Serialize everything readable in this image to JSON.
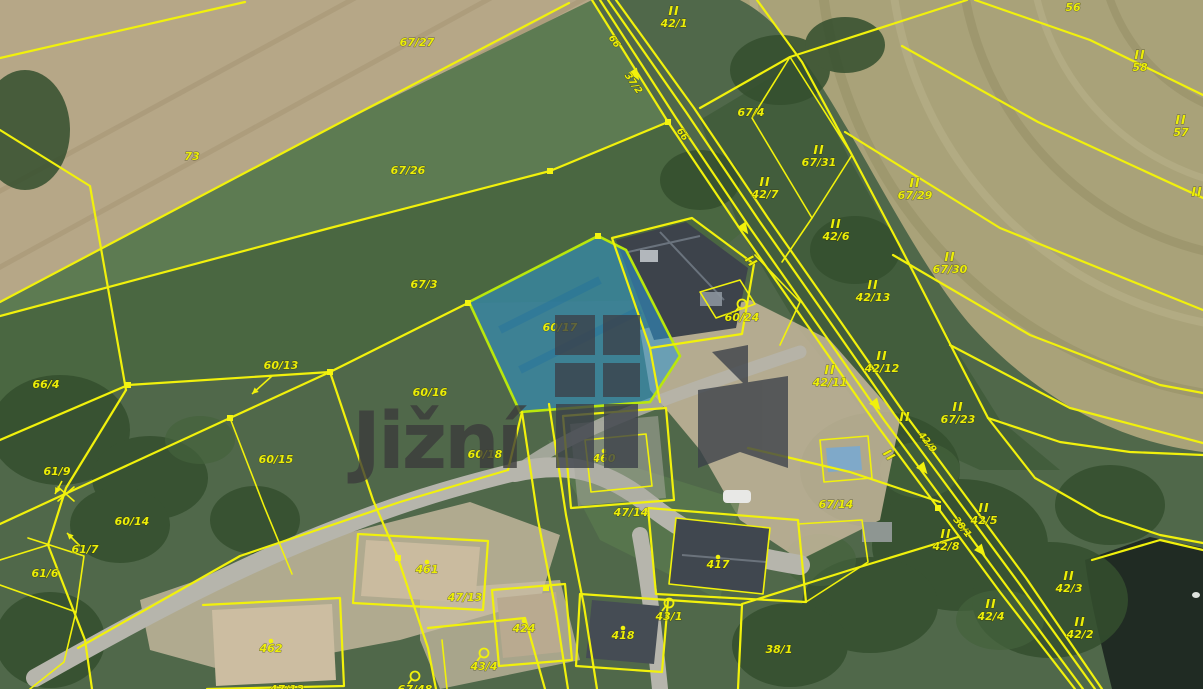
{
  "map": {
    "kind": "cadastral-parcel-map-over-orthophoto",
    "watermark": {
      "text": "Jižní",
      "color": "#3b3b3b"
    },
    "highlighted_parcel": {
      "number": "60/17",
      "fill": "#2e96d2",
      "outline": "#b9e70c"
    },
    "colors": {
      "parcel_line": "#f1f10c",
      "label_text": "#ecee08",
      "grass_green": "#50684a",
      "field_tan": "#b6a787",
      "field_olive": "#a9a279",
      "road_gray": "#b6b5ac",
      "water_dark": "#202b23"
    },
    "labels": [
      {
        "text": "67/27",
        "x": 417,
        "y": 46
      },
      {
        "text": "73",
        "x": 192,
        "y": 160
      },
      {
        "text": "67/26",
        "x": 408,
        "y": 174
      },
      {
        "text": "67/3",
        "x": 424,
        "y": 288
      },
      {
        "text": "66/4",
        "x": 46,
        "y": 388
      },
      {
        "text": "42/1",
        "x": 674,
        "y": 27,
        "marker": "ii"
      },
      {
        "text": "67/4",
        "x": 751,
        "y": 116
      },
      {
        "text": "56",
        "x": 1073,
        "y": 11
      },
      {
        "text": "58",
        "x": 1140,
        "y": 71,
        "marker": "ii"
      },
      {
        "text": "57",
        "x": 1181,
        "y": 136,
        "marker": "ii"
      },
      {
        "text": "67/31",
        "x": 819,
        "y": 166,
        "marker": "ii"
      },
      {
        "text": "42/7",
        "x": 765,
        "y": 198,
        "marker": "ii"
      },
      {
        "text": "67/29",
        "x": 915,
        "y": 199,
        "marker": "ii"
      },
      {
        "text": "42/6",
        "x": 836,
        "y": 240,
        "marker": "ii"
      },
      {
        "text": "67/30",
        "x": 950,
        "y": 273,
        "marker": "ii"
      },
      {
        "text": "42/13",
        "x": 873,
        "y": 301,
        "marker": "ii"
      },
      {
        "text": "42/12",
        "x": 882,
        "y": 372,
        "marker": "ii"
      },
      {
        "text": "42/11",
        "x": 830,
        "y": 386,
        "marker": "ii"
      },
      {
        "text": "67/23",
        "x": 958,
        "y": 423,
        "marker": "ii"
      },
      {
        "text": "",
        "x": 905,
        "y": 421,
        "marker": "ii_only"
      },
      {
        "text": "",
        "x": 886,
        "y": 458,
        "marker": "ii_only",
        "rot": 50
      },
      {
        "text": "",
        "x": 748,
        "y": 264,
        "marker": "ii_only",
        "rot": 50
      },
      {
        "text": "",
        "x": 1197,
        "y": 196,
        "marker": "ii_only"
      },
      {
        "text": "42/9",
        "x": 925,
        "y": 444,
        "rot": 52,
        "small": true
      },
      {
        "text": "38/1",
        "x": 960,
        "y": 529,
        "rot": 52,
        "small": true
      },
      {
        "text": "37/2",
        "x": 631,
        "y": 85,
        "rot": 55,
        "small": true
      },
      {
        "text": "66",
        "x": 612,
        "y": 43,
        "rot": 55,
        "small": true
      },
      {
        "text": "66",
        "x": 680,
        "y": 136,
        "rot": 55,
        "small": true
      },
      {
        "text": "60/13",
        "x": 281,
        "y": 369,
        "arrow": {
          "x1": 272,
          "y1": 376,
          "x2": 252,
          "y2": 394
        }
      },
      {
        "text": "61/9",
        "x": 57,
        "y": 475,
        "arrow": {
          "x1": 62,
          "y1": 481,
          "x2": 55,
          "y2": 494
        }
      },
      {
        "text": "60/16",
        "x": 430,
        "y": 396
      },
      {
        "text": "60/15",
        "x": 276,
        "y": 463
      },
      {
        "text": "60/17",
        "x": 560,
        "y": 331
      },
      {
        "text": "60/18",
        "x": 485,
        "y": 458
      },
      {
        "text": "60/24",
        "x": 742,
        "y": 321,
        "marker": "mag"
      },
      {
        "text": "60/14",
        "x": 132,
        "y": 525
      },
      {
        "text": "61/7",
        "x": 85,
        "y": 553,
        "arrow": {
          "x1": 80,
          "y1": 546,
          "x2": 67,
          "y2": 533
        }
      },
      {
        "text": "61/6",
        "x": 45,
        "y": 577
      },
      {
        "text": "462",
        "x": 271,
        "y": 652,
        "marker": "dot"
      },
      {
        "text": "461",
        "x": 427,
        "y": 573,
        "marker": "dot"
      },
      {
        "text": "460",
        "x": 604,
        "y": 462,
        "marker": "dot"
      },
      {
        "text": "424",
        "x": 524,
        "y": 632,
        "marker": "dot"
      },
      {
        "text": "47/13",
        "x": 465,
        "y": 601
      },
      {
        "text": "47/14",
        "x": 631,
        "y": 516
      },
      {
        "text": "417",
        "x": 718,
        "y": 568,
        "marker": "dot"
      },
      {
        "text": "418",
        "x": 623,
        "y": 639,
        "marker": "dot"
      },
      {
        "text": "43/1",
        "x": 669,
        "y": 620,
        "marker": "mag"
      },
      {
        "text": "43/4",
        "x": 484,
        "y": 670,
        "marker": "mag"
      },
      {
        "text": "67/48",
        "x": 415,
        "y": 693,
        "marker": "mag"
      },
      {
        "text": "47/12",
        "x": 287,
        "y": 693
      },
      {
        "text": "67/14",
        "x": 836,
        "y": 508
      },
      {
        "text": "42/5",
        "x": 984,
        "y": 524,
        "marker": "ii"
      },
      {
        "text": "42/8",
        "x": 946,
        "y": 550,
        "marker": "ii"
      },
      {
        "text": "42/3",
        "x": 1069,
        "y": 592,
        "marker": "ii"
      },
      {
        "text": "42/4",
        "x": 991,
        "y": 620,
        "marker": "ii"
      },
      {
        "text": "42/2",
        "x": 1080,
        "y": 638,
        "marker": "ii"
      },
      {
        "text": "38/1",
        "x": 779,
        "y": 653
      }
    ],
    "road_arrows": [
      {
        "x": 637,
        "y": 77,
        "rot": 57
      },
      {
        "x": 746,
        "y": 231,
        "rot": 55
      },
      {
        "x": 878,
        "y": 407,
        "rot": 52
      },
      {
        "x": 925,
        "y": 471,
        "rot": 51
      },
      {
        "x": 983,
        "y": 553,
        "rot": 50
      }
    ]
  }
}
